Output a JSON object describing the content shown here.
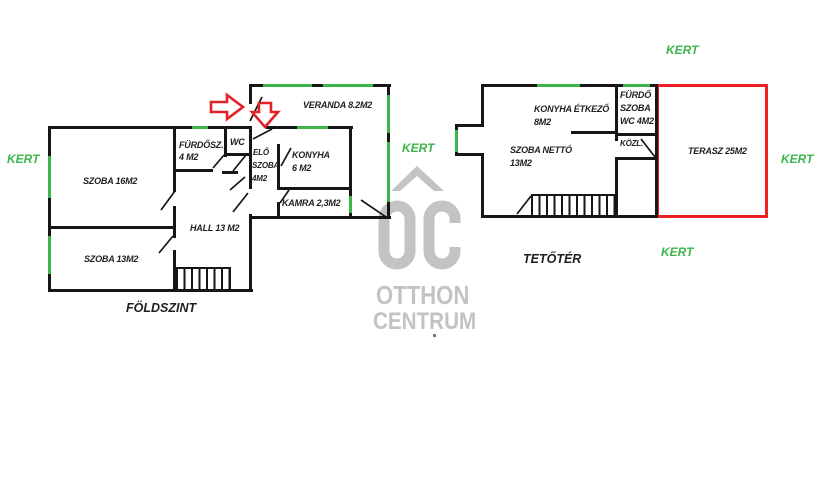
{
  "colors": {
    "wall": "#161616",
    "window": "#3cb54a",
    "terrace": "#ed2024",
    "arrow": "#e32227",
    "watermark": "#c3c3c3",
    "text": "#1f1f1f"
  },
  "ground_floor": {
    "title": "FÖLDSZINT",
    "rooms": {
      "szoba16": {
        "label": "SZOBA 16M2"
      },
      "szoba13": {
        "label": "SZOBA 13M2"
      },
      "furdosz": {
        "line1": "FÜRDŐSZ.",
        "line2": "4 M2"
      },
      "wc": {
        "label": "WC"
      },
      "eloszoba": {
        "line1": "ELŐ",
        "line2": "SZOBA",
        "line3": "4M2"
      },
      "konyha": {
        "line1": "KONYHA",
        "line2": "6 M2"
      },
      "kamra": {
        "label": "KAMRA 2,3M2"
      },
      "veranda": {
        "label": "VERANDA 8.2M2"
      },
      "hall": {
        "label": "HALL 13 M2"
      }
    }
  },
  "attic": {
    "title": "TETŐTÉR",
    "rooms": {
      "konyha_etkezo": {
        "line1": "KONYHA ÉTKEZŐ",
        "line2": "8M2"
      },
      "szoba_netto": {
        "line1": "SZOBA NETTÓ",
        "line2": "13M2"
      },
      "furdo_szoba_wc": {
        "line1": "FÜRDŐ",
        "line2": "SZOBA",
        "line3": "WC 4M2"
      },
      "kozl": {
        "label": "KÖZL."
      },
      "terasz": {
        "label": "TERASZ 25M2"
      }
    }
  },
  "garden_label": "KERT",
  "watermark": {
    "line1": "OTTHON",
    "line2": "CENTRUM"
  }
}
